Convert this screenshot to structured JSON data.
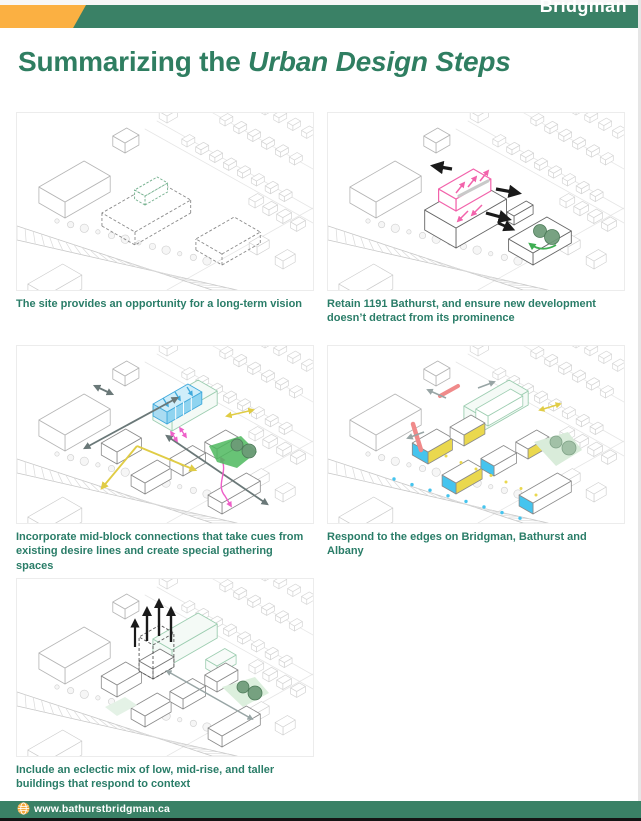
{
  "header": {
    "logo_text": "Bridgman",
    "green": "#3A8166",
    "orange": "#FBB042"
  },
  "title": {
    "prefix": "Summarizing the ",
    "emphasis": "Urban Design Steps",
    "color": "#2F7E61"
  },
  "panels": [
    {
      "name": "long-term-vision",
      "caption_lines": [
        "The site provides an opportunity for a long-term vision"
      ]
    },
    {
      "name": "retain-1191-bathurst",
      "caption_lines": [
        "Retain 1191 Bathurst, and ensure new development",
        "doesn’t detract from its prominence"
      ]
    },
    {
      "name": "mid-block-connections",
      "caption_lines": [
        "Incorporate mid-block connections that take cues from",
        "existing desire lines and create special gathering spaces"
      ]
    },
    {
      "name": "respond-to-edges",
      "caption_lines": [
        "Respond to the edges on Bridgman, Bathurst and",
        "Albany"
      ]
    },
    {
      "name": "eclectic-mix",
      "caption_lines": [
        "Include an eclectic mix of low, mid-rise, and taller",
        "buildings that respond to context"
      ]
    }
  ],
  "footer": {
    "url": "www.bathurstbridgman.ca",
    "globe_color": "#F5A93B"
  },
  "caption_color": "#2A7D68"
}
